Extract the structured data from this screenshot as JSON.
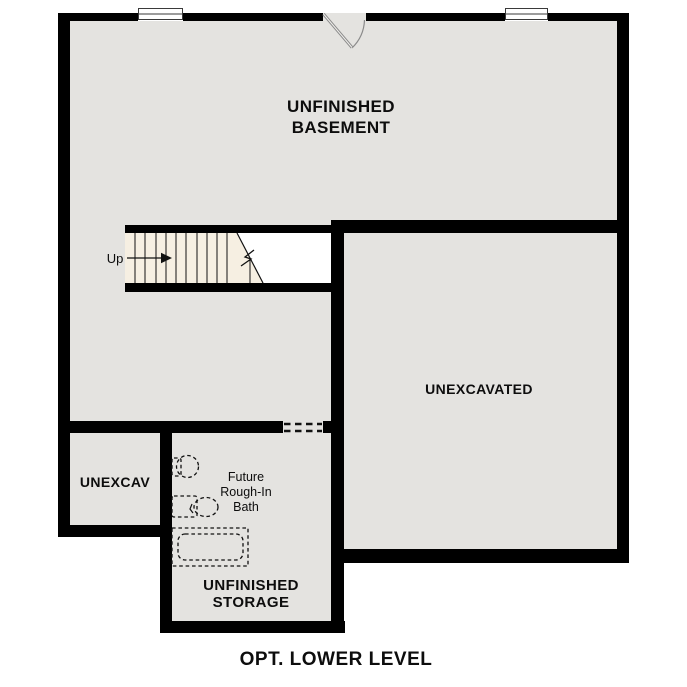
{
  "title": "OPT. LOWER LEVEL",
  "rooms": {
    "basement": {
      "label_line1": "UNFINISHED",
      "label_line2": "BASEMENT"
    },
    "unexcavated": {
      "label": "UNEXCAVATED"
    },
    "unexcav_small": {
      "label": "UNEXCAV"
    },
    "storage": {
      "label_line1": "UNFINISHED",
      "label_line2": "STORAGE"
    },
    "future_bath": {
      "label_line1": "Future",
      "label_line2": "Rough-In",
      "label_line3": "Bath"
    }
  },
  "stairs": {
    "direction_label": "Up"
  },
  "colors": {
    "wall": "#000000",
    "room": "#e4e3e0",
    "tread": "#f6efe2",
    "line": "#111111",
    "door": "#8a8a8a",
    "text": "#0d0d0d",
    "bg": "#ffffff"
  }
}
